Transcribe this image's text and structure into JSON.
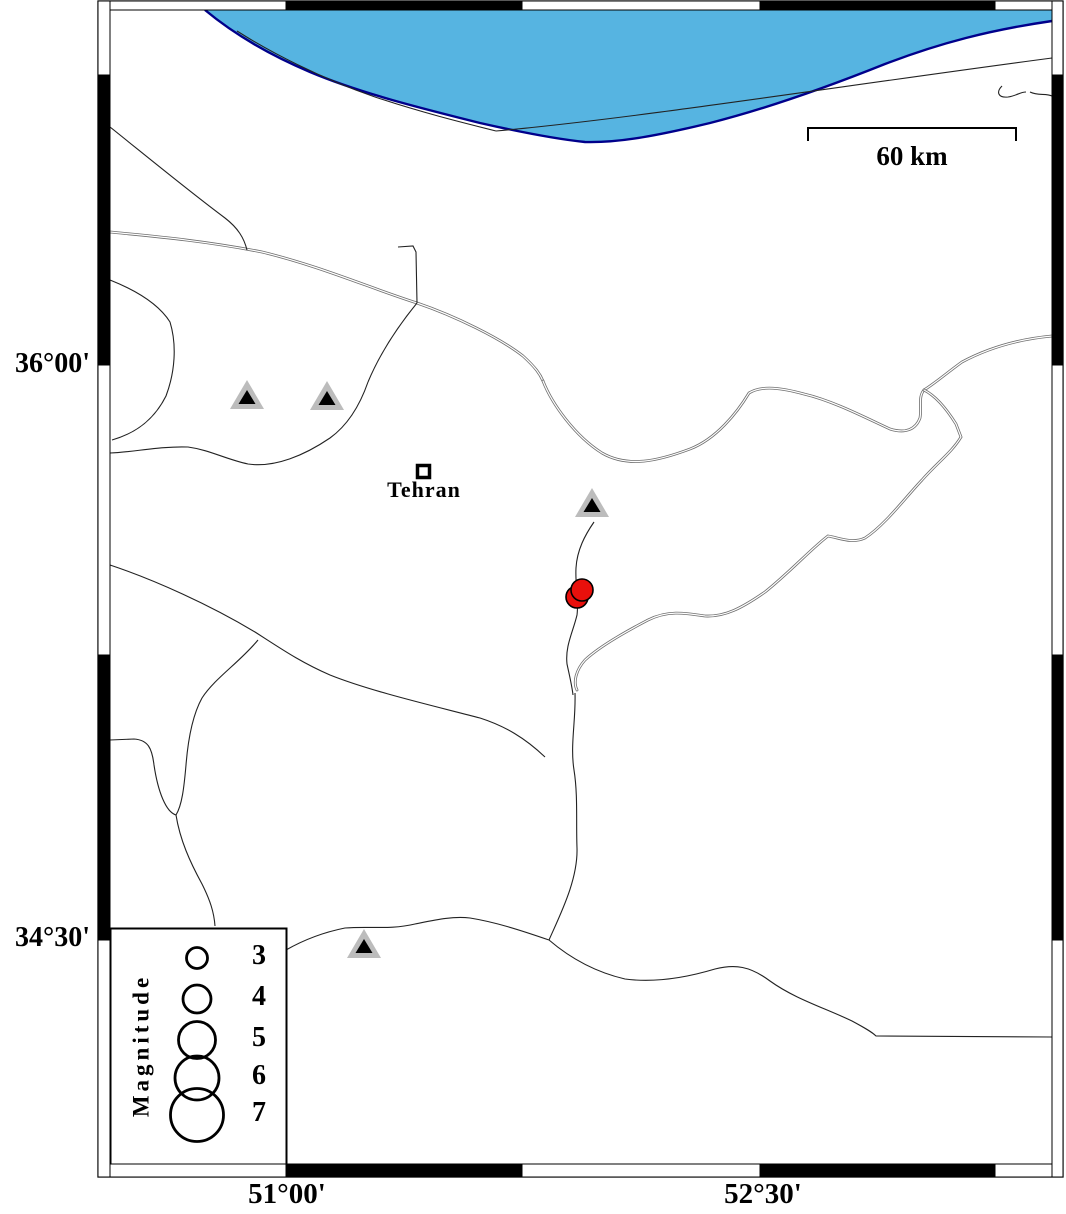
{
  "map": {
    "labels": {
      "city": "Tehran",
      "scale_bar": "60 km",
      "legend_title": "Magnitude"
    },
    "axis": {
      "lat_top": "36°00'",
      "lat_bottom": "34°30'",
      "lon_left": "51°00'",
      "lon_right": "52°30'"
    },
    "legend": {
      "title": "Magnitude",
      "entries": [
        {
          "label": "3",
          "cy": 958,
          "r": 10.5
        },
        {
          "label": "4",
          "cy": 999,
          "r": 14
        },
        {
          "label": "5",
          "cy": 1040,
          "r": 18.5
        },
        {
          "label": "6",
          "cy": 1078,
          "r": 22
        },
        {
          "label": "7",
          "cy": 1115,
          "r": 26.5
        }
      ],
      "box": {
        "x": 110,
        "y": 928,
        "w": 176,
        "h": 236,
        "circle_cx": 197
      }
    },
    "colors": {
      "sea": "#56B4E1",
      "sea_edge": "#00008B",
      "land": "#FFFFFF",
      "line_single": "#222222",
      "line_double": "#6F6F6F",
      "station_gray": "#BCBCBC",
      "station_core": "#000000",
      "quake_red": "#E8100C",
      "frame": "#000000"
    },
    "symbols": {
      "stations": [
        {
          "cx": 247,
          "cy": 397
        },
        {
          "cx": 327,
          "cy": 398
        },
        {
          "cx": 592,
          "cy": 505
        },
        {
          "cx": 364,
          "cy": 946
        }
      ],
      "earthquakes": [
        {
          "cx": 577,
          "cy": 597,
          "r": 11
        },
        {
          "cx": 582,
          "cy": 590,
          "r": 11
        }
      ],
      "city_marker": {
        "x": 417.5,
        "y": 465.5,
        "size": 12
      }
    },
    "scalebar": {
      "x1": 808,
      "x2": 1016,
      "y": 128,
      "tick_drop": 13
    },
    "frame": {
      "outer": {
        "x1": 98,
        "y1": 1,
        "x2": 1063,
        "y2": 1177
      },
      "inner": {
        "x1": 110,
        "y1": 10,
        "x2": 1052,
        "y2": 1164
      },
      "x_bounds": [
        98,
        286,
        522,
        760,
        995,
        1063
      ],
      "y_bounds": [
        1,
        75,
        365,
        655,
        940,
        1177
      ],
      "x_fills": [
        "w",
        "b",
        "w",
        "b",
        "w"
      ],
      "y_fills": [
        "w",
        "b",
        "w",
        "b",
        "w"
      ]
    },
    "geometry": {
      "sea_fill": "M 205,10 C 235,35 270,55 310,72 C 360,93 420,108 480,123 C 520,132 555,139 585,142 C 620,143 660,135 710,123 C 765,109 830,86 885,64 C 940,43 990,30 1052,21 L 1052,10 Z",
      "sea_edge": "M 205,10 C 235,35 270,55 310,72 C 360,93 420,108 480,123 C 520,132 555,139 585,142 C 620,143 660,135 710,123 C 765,109 830,86 885,64 C 940,43 990,30 1052,21",
      "double_lines": [
        "M 110,232 C 150,236 200,240 262,252 C 320,266 370,288 417,303 C 455,316 500,338 523,356 C 536,368 540,374 543,381",
        "M 543,381 C 552,404 575,436 602,453 C 628,468 658,461 690,449 C 716,439 737,413 749,393 C 762,385 782,388 804,394 C 834,401 868,419 890,429 C 906,434 916,429 920,418 C 922,406 918,397 924,390",
        "M 924,390 C 934,384 948,372 962,362 C 990,347 1020,339 1052,336",
        "M 924,390 C 936,396 946,408 956,424 L 961,437 C 952,452 938,462 922,480 C 905,498 885,525 865,538 C 852,544 840,538 828,536 C 812,548 790,572 765,592 C 742,608 725,617 705,616 C 685,613 668,610 648,620 C 625,632 600,646 585,660 C 576,670 573,682 577,690"
      ],
      "single_lines": [
        "M 110,127 C 145,155 190,192 225,218 C 238,228 244,238 247,250",
        "M 110,280 C 135,290 158,303 170,322 C 177,345 175,372 166,396 C 156,416 140,432 112,440",
        "M 398,247 L 413,246 L 416,252 L 417,303",
        "M 368,382 C 360,405 348,425 330,438 C 305,455 275,468 248,464 C 225,459 210,450 188,447 C 160,446 135,452 110,453",
        "M 368,382 C 378,358 395,330 417,303",
        "M 594,522 C 585,535 577,550 576,568 C 575,585 579,600 577,615 C 573,632 565,646 567,664 C 570,678 572,686 573,695",
        "M 575,693 C 576,720 570,745 574,770 C 578,795 576,822 577,848 C 578,880 560,915 549,940",
        "M 110,565 C 155,580 210,605 255,632 C 280,648 300,662 330,675 C 370,691 430,705 480,718 C 505,726 525,738 545,757",
        "M 258,640 C 240,662 215,678 202,698 C 192,716 188,740 186,765 C 184,788 182,805 176,815 C 166,812 158,792 154,765 C 152,748 148,740 134,739 L 110,740",
        "M 176,815 C 180,840 190,862 202,884 C 210,900 214,912 215,926",
        "M 286,950 C 300,942 320,933 345,928 C 370,926 390,930 415,924 C 435,920 452,916 470,918 C 495,922 520,930 549,940",
        "M 549,940 C 570,958 595,972 625,979 C 655,983 685,978 715,969 C 735,964 750,966 770,981 C 795,999 825,1008 852,1021 C 865,1028 872,1032 876,1036 L 1052,1037",
        "M 237,31 C 270,52 320,78 375,97 C 420,112 460,122 496,131",
        "M 496,131 C 640,118 840,86 1052,58",
        "M 1002,86 C 996,92 998,98 1008,97 C 1016,96 1020,92 1026,92",
        "M 1030,92 C 1038,96 1046,93 1052,96"
      ]
    }
  }
}
